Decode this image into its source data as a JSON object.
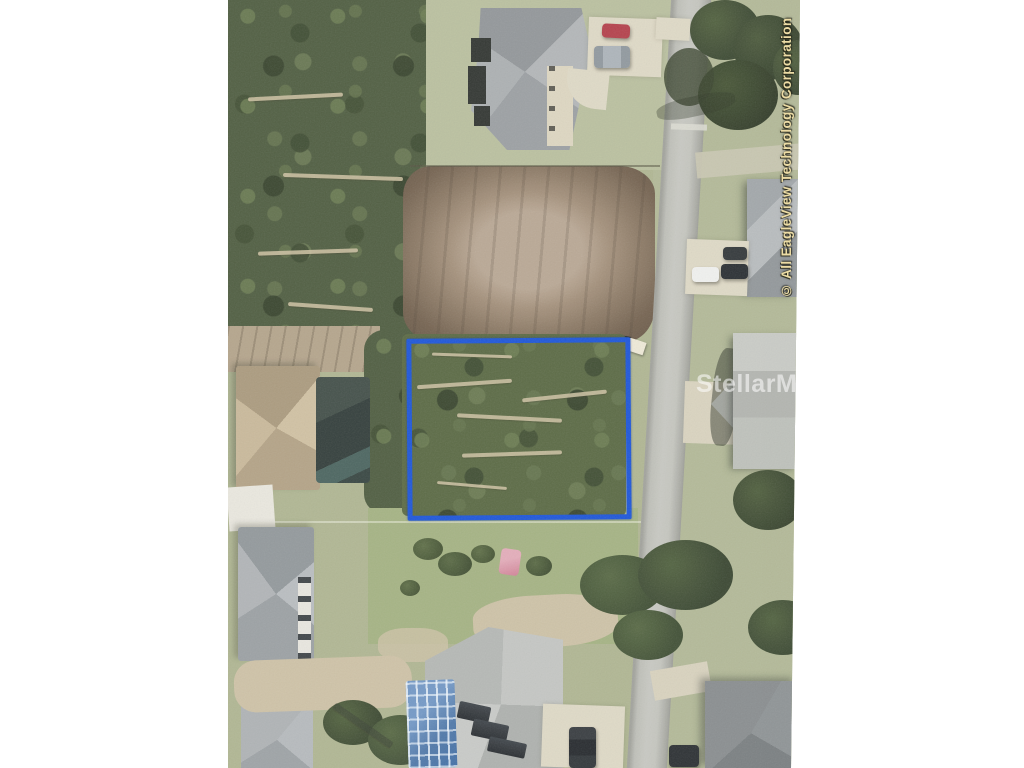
{
  "page": {
    "background_color": "#ffffff"
  },
  "photo": {
    "kind": "aerial-photograph",
    "center_watermark": "StellarMLS",
    "edge_copyright": "© All EagleView Technology Corporation",
    "lot_boundary_color": "#1550d8"
  }
}
